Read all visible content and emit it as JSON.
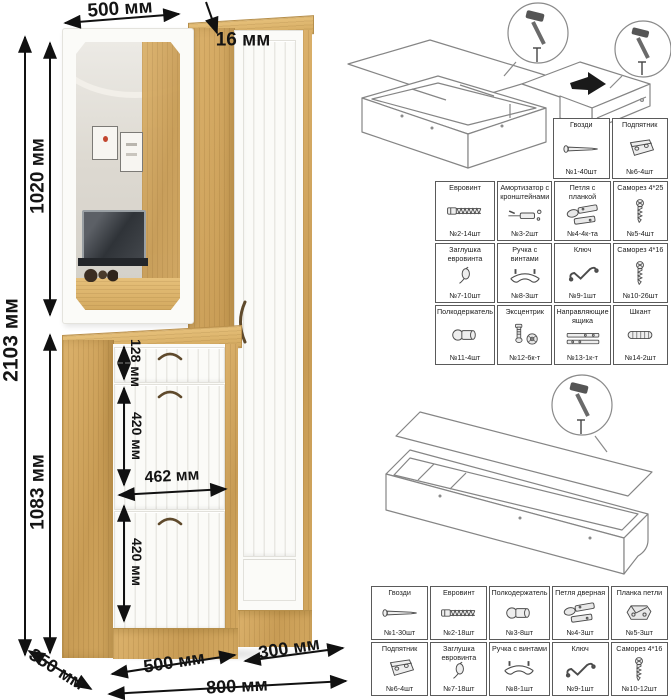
{
  "furniture_drawing": {
    "dims": {
      "total_height": "2103 мм",
      "upper_height": "1020 мм",
      "lower_height": "1083 мм",
      "top_width": "500 мм",
      "panel_thickness": "16 мм",
      "drawer_height": "128 мм",
      "flap1_height": "420 мм",
      "inner_width": "462 мм",
      "flap2_height": "420 мм",
      "depth": "350 мм",
      "bottom_left_width": "500 мм",
      "bottom_right_width": "300 мм",
      "total_width": "800 мм"
    },
    "colors": {
      "wood": "#d2a75f",
      "front": "#fbfbf8",
      "handle": "#5f4a2c"
    }
  },
  "hardware_kit_top": {
    "rows": [
      {
        "cells": [
          {
            "label": "Гвозди",
            "qty": "№1-40шт",
            "icon": "nail-icon"
          },
          {
            "label": "Подпятник",
            "qty": "№6-4шт",
            "icon": "footpad-icon"
          }
        ]
      },
      {
        "cells": [
          {
            "label": "Евровинт",
            "qty": "№2-14шт",
            "icon": "euroscrew-icon"
          },
          {
            "label": "Амортизатор с кронштейнами",
            "qty": "№3-2шт",
            "icon": "gasstrut-icon"
          },
          {
            "label": "Петля с планкой",
            "qty": "№4-4к-та",
            "icon": "hinge-icon"
          },
          {
            "label": "Саморез 4*25",
            "qty": "№5-4шт",
            "icon": "screw-icon"
          }
        ]
      },
      {
        "cells": [
          {
            "label": "Заглушка евровинта",
            "qty": "№7-10шт",
            "icon": "cap-icon"
          },
          {
            "label": "Ручка с винтами",
            "qty": "№8-3шт",
            "icon": "handle-icon"
          },
          {
            "label": "Ключ",
            "qty": "№9-1шт",
            "icon": "key-icon"
          },
          {
            "label": "Саморез 4*16",
            "qty": "№10-26шт",
            "icon": "screw-icon"
          }
        ]
      },
      {
        "cells": [
          {
            "label": "Полкодержатель",
            "qty": "№11-4шт",
            "icon": "shelfpin-icon"
          },
          {
            "label": "Эксцентрик",
            "qty": "№12-6к-т",
            "icon": "cam-icon"
          },
          {
            "label": "Направляющие ящика",
            "qty": "№13-1к-т",
            "icon": "slides-icon"
          },
          {
            "label": "Шкант",
            "qty": "№14-2шт",
            "icon": "dowel-icon"
          }
        ]
      }
    ]
  },
  "hardware_kit_bottom": {
    "rows": [
      {
        "cells": [
          {
            "label": "Гвозди",
            "qty": "№1-30шт",
            "icon": "nail-icon"
          },
          {
            "label": "Евровинт",
            "qty": "№2-18шт",
            "icon": "euroscrew-icon"
          },
          {
            "label": "Полкодержатель",
            "qty": "№3-8шт",
            "icon": "shelfpin-icon"
          },
          {
            "label": "Петля дверная",
            "qty": "№4-3шт",
            "icon": "hinge-icon"
          },
          {
            "label": "Планка петли",
            "qty": "№5-3шт",
            "icon": "hingeplate-icon"
          }
        ]
      },
      {
        "cells": [
          {
            "label": "Подпятник",
            "qty": "№6-4шт",
            "icon": "footpad-icon"
          },
          {
            "label": "Заглушка евровинта",
            "qty": "№7-18шт",
            "icon": "cap-icon"
          },
          {
            "label": "Ручка с винтами",
            "qty": "№8-1шт",
            "icon": "handle-icon"
          },
          {
            "label": "Ключ",
            "qty": "№9-1шт",
            "icon": "key-icon"
          },
          {
            "label": "Саморез 4*16",
            "qty": "№10-12шт",
            "icon": "screw-icon"
          }
        ]
      }
    ]
  }
}
